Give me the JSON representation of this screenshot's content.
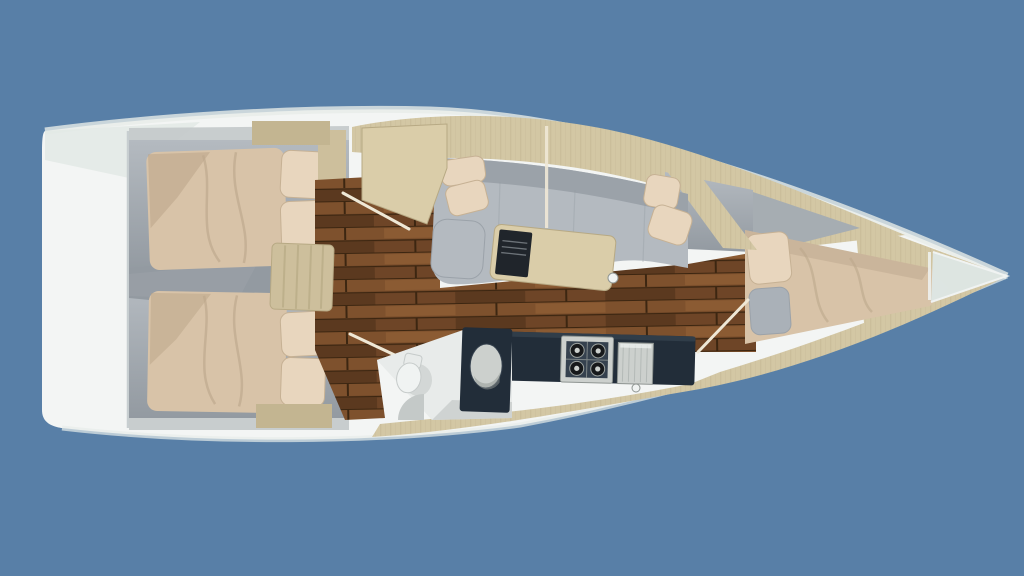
{
  "scene": {
    "subject": "sailboat-yacht-interior-floorplan-top-view",
    "background_color": "#587fa7"
  },
  "colors": {
    "background": "#587fa7",
    "hull_white": "#f3f5f4",
    "hull_rim": "#e7ece9",
    "hull_tint": "#e2e9e5",
    "hull_shadow": "#c7ced0",
    "deck_sand": "#d3c7a4",
    "deck_sand_dark": "#c3b591",
    "wood_trim": "#cdbf9c",
    "cabin_gray": "#a6adb2",
    "cabin_gray_dark": "#939aa1",
    "wall_gray": "#c3c9ca",
    "seat_gray": "#b4bac0",
    "seat_gray_dark": "#9ba2a9",
    "bed_beige": "#d8c3a8",
    "bed_fold": "#bda88c",
    "bed_shadow": "#b7a186",
    "pillow_beige": "#e8d6be",
    "pillow_edge": "#c6b194",
    "pillow_gray": "#aab1b8",
    "walnut": "#6e4527",
    "walnut_light": "#7e512d",
    "walnut_light2": "#8f5e34",
    "walnut_dark": "#4a2f18",
    "walnut_seam": "#3c2611",
    "navy": "#222d39",
    "navy_light": "#35414e",
    "steel": "#ccd0cd",
    "steel_dark": "#8f9592",
    "steel_line": "#aeb4b1",
    "burner_dark": "#17191b",
    "grate_line": "#9da3a0",
    "table_wood": "#dacda9",
    "table_edge": "#b7a984",
    "tv_dark": "#20252b",
    "tv_line": "#767c82",
    "white": "#f0f3f2",
    "off_white": "#e8ebea",
    "shade_gray": "#c4c9c8",
    "glass": "#dde7e5",
    "door_wood": "#efe8d6",
    "fixture_stroke": "#c6cbca"
  },
  "parts": [
    "hull",
    "transom",
    "aft-cabin-port",
    "aft-cabin-starboard",
    "double-bed-port",
    "double-bed-starboard",
    "pillows",
    "companionway-stairs",
    "walnut-floor",
    "chart-table",
    "nav-seat",
    "salon-sofa",
    "salon-table",
    "tv-unit",
    "galley-counter",
    "stove",
    "galley-sink",
    "head-compartment",
    "toilet",
    "vanity-sink",
    "forward-cabin",
    "v-berth-bed",
    "bow-anchor-locker",
    "side-decks",
    "mast-post"
  ]
}
